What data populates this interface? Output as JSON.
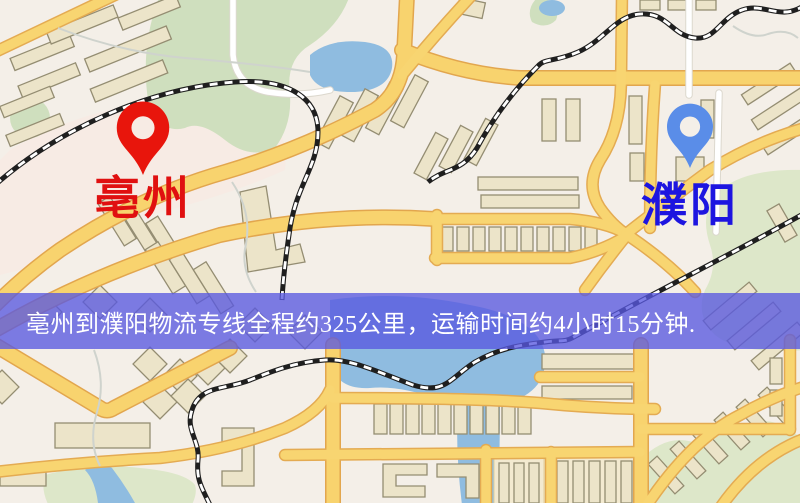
{
  "banner": {
    "text": "亳州到濮阳物流专线全程约325公里，运输时间约4小时15分钟.",
    "background_color": "#5858e0",
    "text_color": "#ffffff"
  },
  "route": {
    "origin_city": "亳州",
    "destination_city": "濮阳",
    "distance": "325公里",
    "duration": "4小时15分钟"
  },
  "markers": {
    "origin": {
      "label": "亳州",
      "pin_color": "#e8150c",
      "label_color": "#e01010",
      "pin_icon": "map-pin-icon"
    },
    "destination": {
      "label": "濮阳",
      "pin_color": "#5a8de8",
      "label_color": "#1d15e0",
      "pin_icon": "map-pin-icon"
    }
  },
  "map_palette": {
    "background": "#f4efe8",
    "road_yellow": "#f8d36e",
    "road_casing": "#e2a64e",
    "park_green": "#cfdfbe",
    "water_blue": "#8fbce0",
    "building_tan": "#ece4c9",
    "railway_black": "#1f1f1f",
    "minor_street_white": "#ffffff"
  }
}
